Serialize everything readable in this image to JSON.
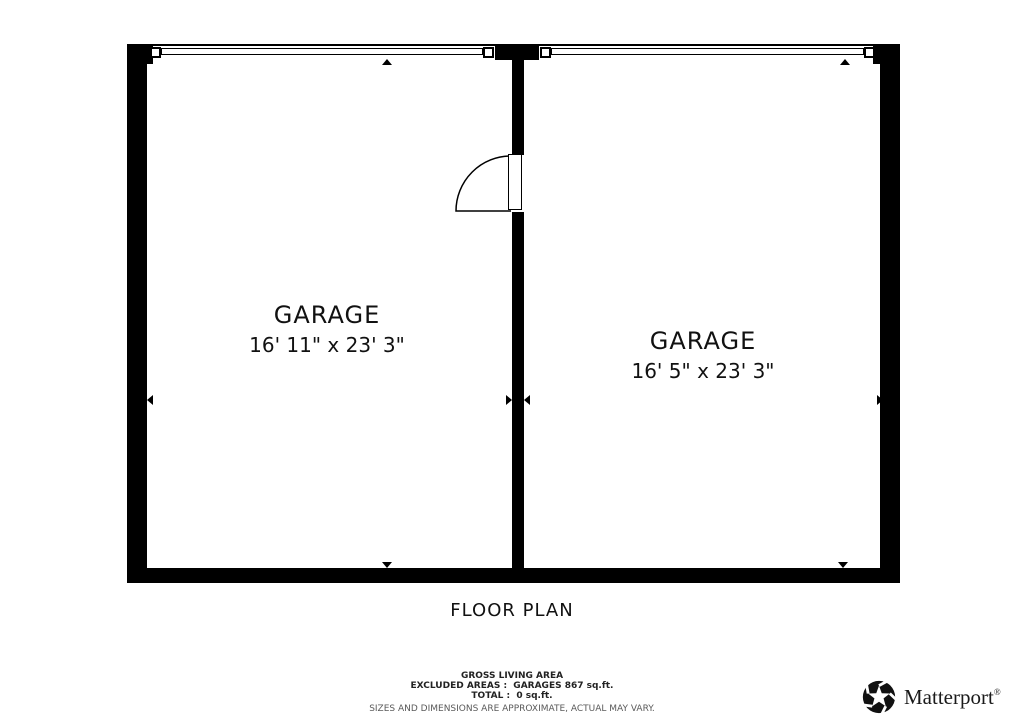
{
  "title": "FLOOR PLAN",
  "rooms": [
    {
      "name": "GARAGE",
      "dimensions": "16' 11\" x 23' 3\""
    },
    {
      "name": "GARAGE",
      "dimensions": "16' 5\" x 23' 3\""
    }
  ],
  "footer": {
    "gross_living_area": "GROSS LIVING AREA",
    "excluded_areas": "EXCLUDED AREAS :  GARAGES 867 sq.ft.",
    "total": "TOTAL :  0 sq.ft.",
    "disclaimer": "SIZES AND DIMENSIONS ARE APPROXIMATE, ACTUAL MAY VARY."
  },
  "branding": {
    "logo_text": "Matterport",
    "registered": "®",
    "logo_icon": "matterport-pinwheel-icon"
  },
  "colors": {
    "wall": "#000000",
    "background": "#ffffff",
    "text": "#111111",
    "disclaimer_text": "#5a5a5a"
  }
}
